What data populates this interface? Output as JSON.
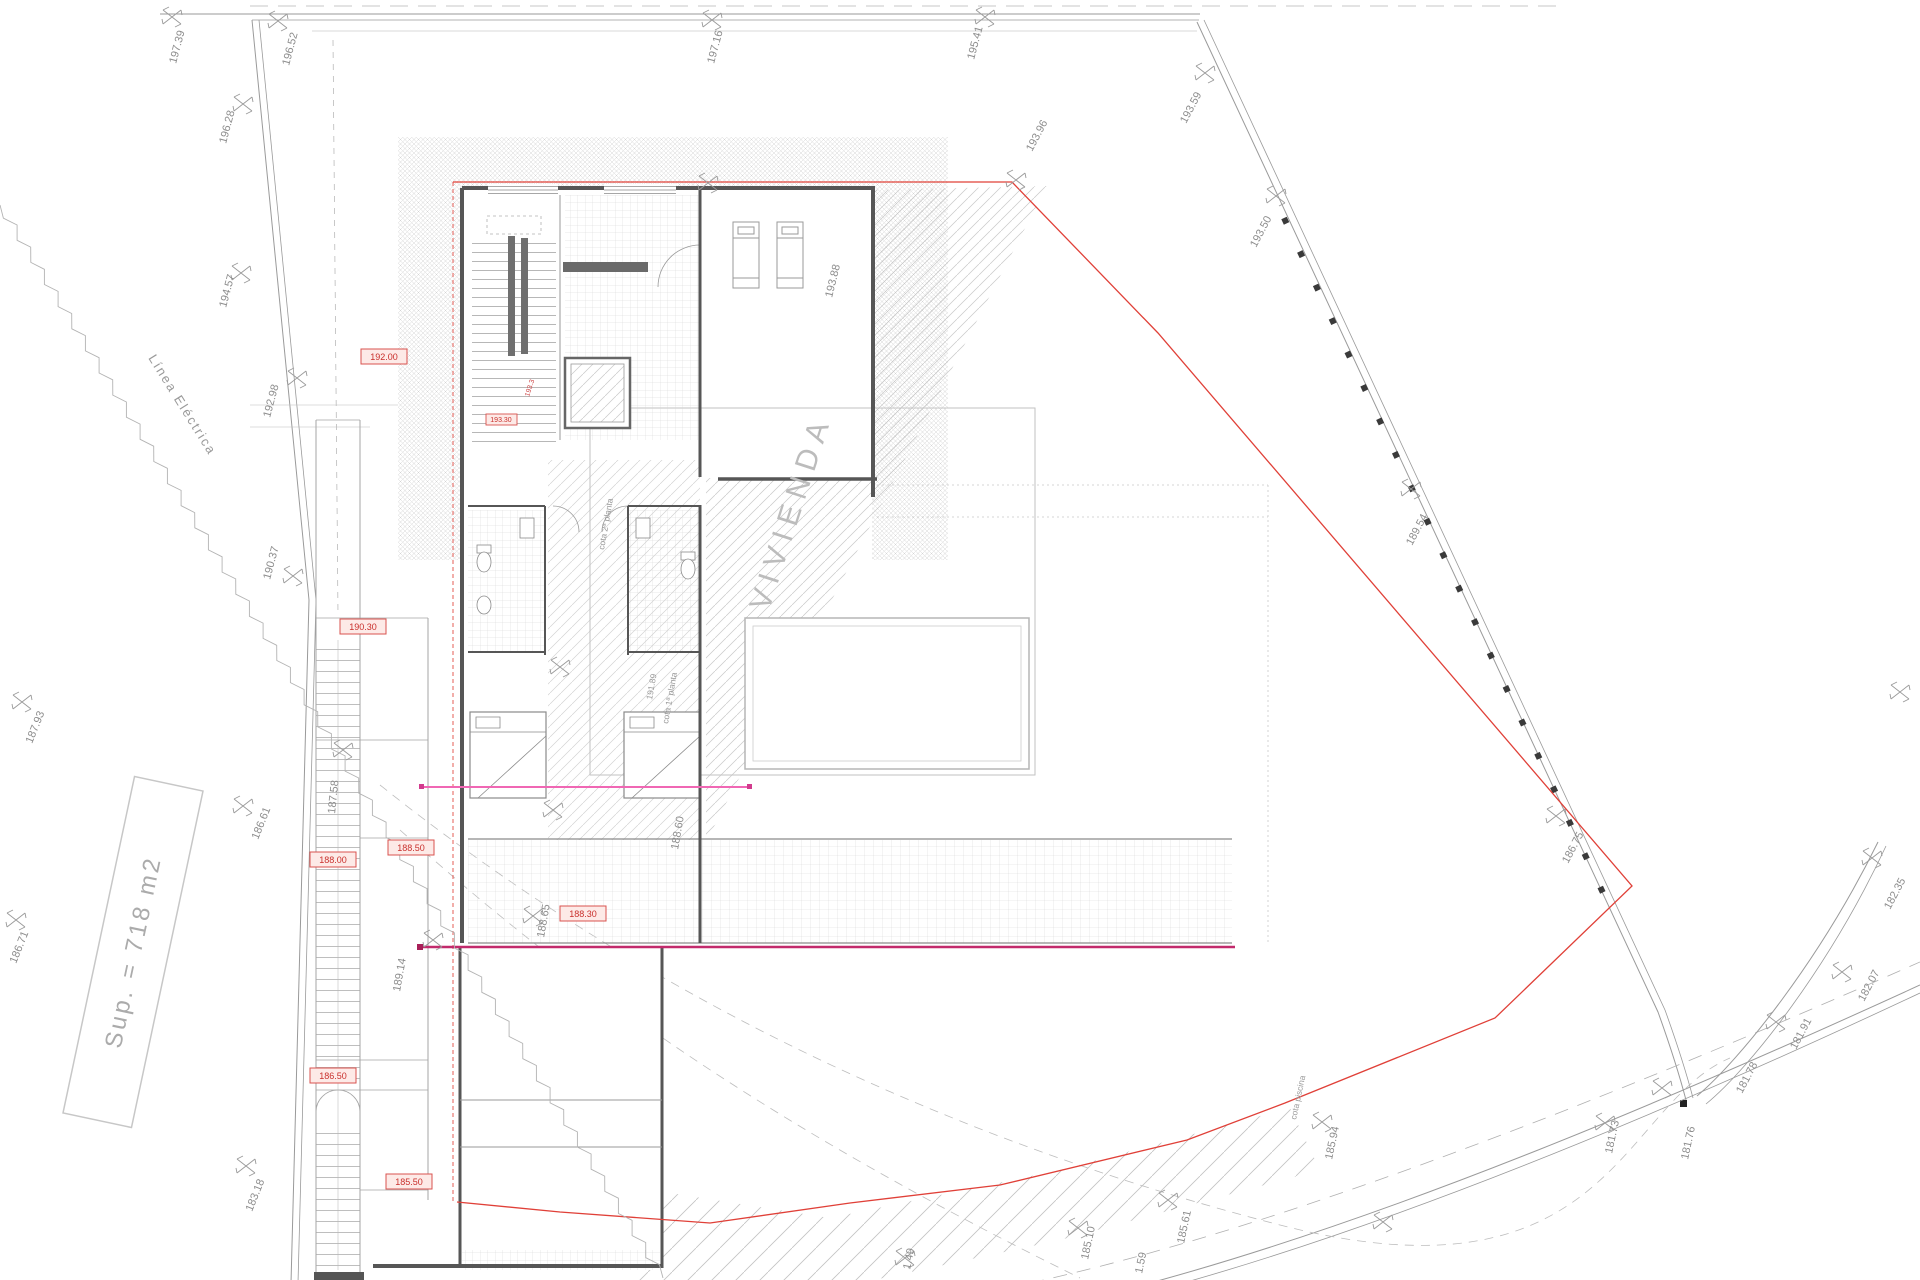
{
  "drawing": {
    "building_label": "VIVIENDA",
    "power_line_label": "Línea Eléctrica",
    "parcel_area_label": "Sup. = 718 m2",
    "boundary_color": "#e04038",
    "section_line_color": "#c22a6c"
  },
  "survey_labels": {
    "t1": "197.39",
    "t2": "196.52",
    "t3": "197.16",
    "t4": "195.41",
    "t5": "193.59",
    "t6": "193.50",
    "t7": "189.54",
    "t8": "186.75",
    "t9": "182.35",
    "t10": "182.07",
    "t11": "181.91",
    "t12": "181.78",
    "t13": "181.76",
    "t14": "181.73",
    "t15": "185.94",
    "t16": "185.61",
    "t17": "185.10",
    "t18": "1.49",
    "t19": "1.59",
    "t20": "196.28",
    "t21": "194.57",
    "t22": "192.98",
    "t23": "190.37",
    "t24": "187.93",
    "t25": "186.61",
    "t26": "186.71",
    "t27": "183.18",
    "t28": "187.58",
    "t29": "189.14",
    "t30": "188.60",
    "t31": "188.65",
    "t32": "193.88",
    "t33": "193.96",
    "t34": "191.89"
  },
  "notes": {
    "cota_piscina": "cota piscina",
    "cota_planta1": "cota 1ª planta",
    "cota_planta2": "cota 2ª planta",
    "cota_tiny": "193.3"
  },
  "red_cotas": {
    "r1": "192.00",
    "r2": "190.30",
    "r3": "193.30",
    "r4": "188.50",
    "r5": "188.00",
    "r6": "188.30",
    "r7": "186.50",
    "r8": "185.50"
  }
}
